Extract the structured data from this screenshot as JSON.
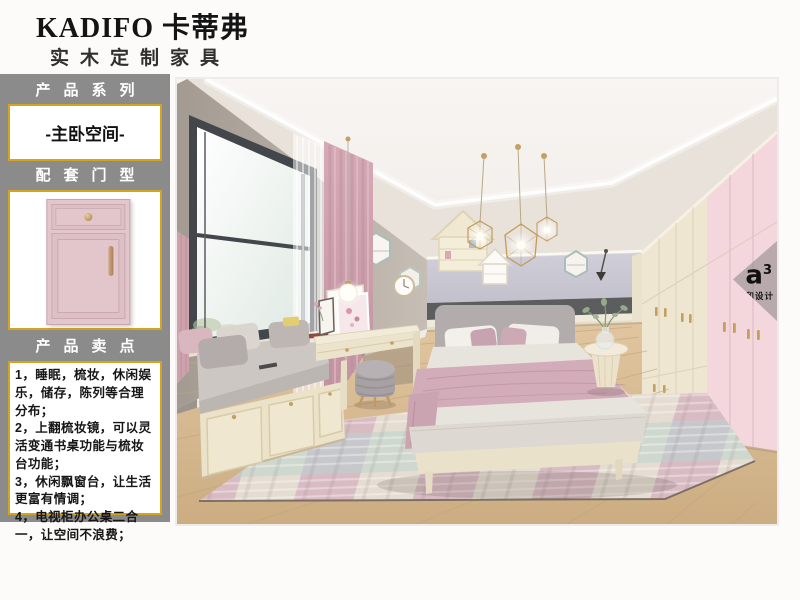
{
  "header": {
    "brand": "KADIFO 卡蒂弗",
    "subtitle": "实木定制家具"
  },
  "sidebar": {
    "series_label": "产品系列",
    "series_value": "-主卧空间-",
    "door_label": "配套门型",
    "selling_label": "产品卖点",
    "selling_points": [
      "1，睡眠，梳妆，休闲娱乐，储存，陈列等合理分布；",
      "2，上翻梳妆镜，可以灵活变通书桌功能与梳妆台功能；",
      "3，休闲飘窗台，让生活更富有情调；",
      "4，电视柜办公桌二合一，让空间不浪费；"
    ]
  },
  "watermark": {
    "logo": "a",
    "logo_sup": "3",
    "label": "家和设计"
  },
  "colors": {
    "accent_gold": "#d6a31f",
    "sidebar_gray": "#8b8b8b",
    "door_pink": "#e2c6cb",
    "wardrobe_pink": "#f3d7dd",
    "cabinet_cream": "#ece3cd",
    "wall_lavender": "#c9c8d2"
  }
}
